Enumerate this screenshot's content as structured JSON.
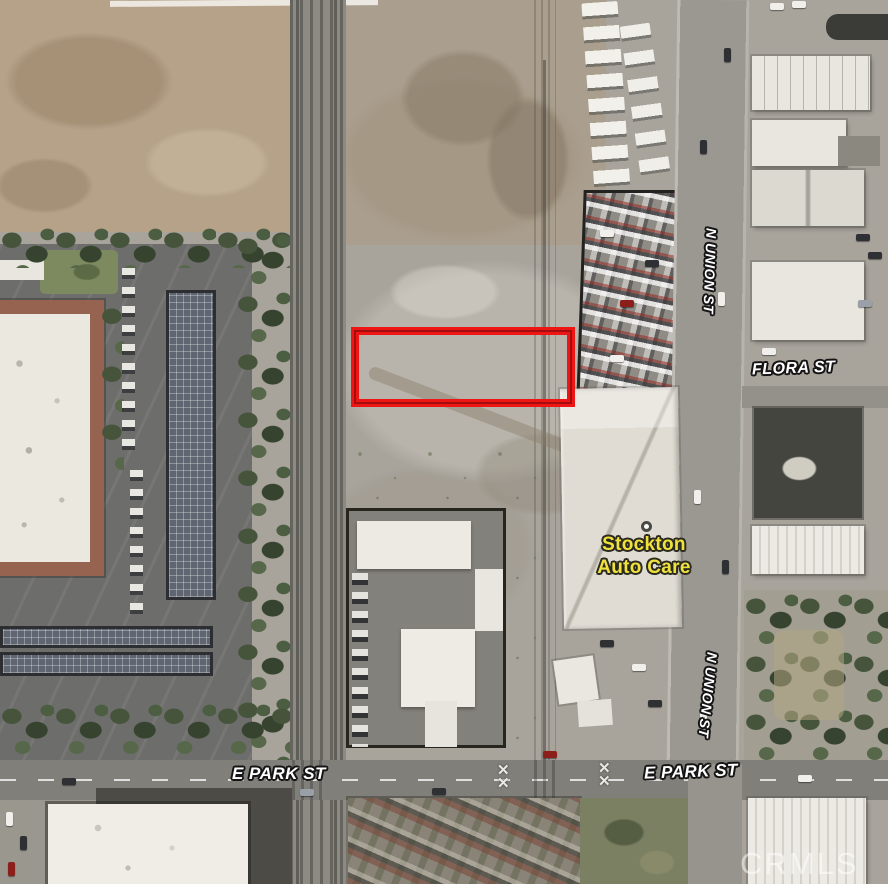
{
  "map": {
    "image_type": "aerial-satellite-photo",
    "watermark": "CRMLS",
    "streets": {
      "n_union_upper": "N UNION ST",
      "n_union_lower": "N UNION ST",
      "flora": "FLORA ST",
      "e_park_left": "E PARK ST",
      "e_park_right": "E PARK ST"
    },
    "poi": {
      "line1": "Stockton",
      "line2": "Auto Care",
      "label_color": "#f0e23c"
    },
    "parcel_highlight": {
      "shape": "rectangle",
      "border_color": "#ee1515"
    },
    "label_colors": {
      "street_text": "#ffffff",
      "street_outline": "#151515",
      "watermark_text": "rgba(255,255,255,0.5)"
    }
  }
}
